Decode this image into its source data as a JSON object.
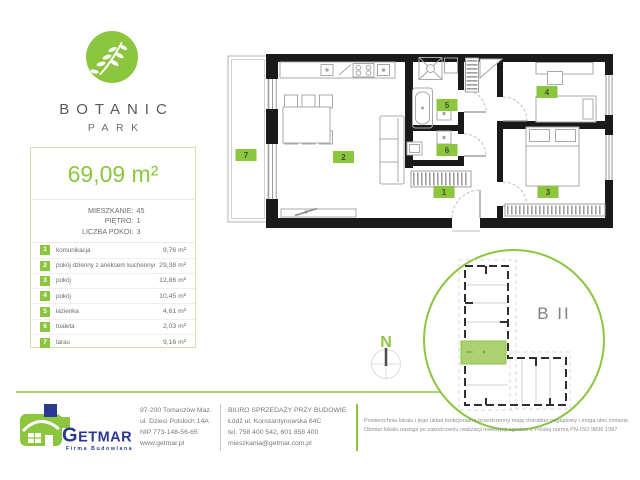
{
  "brand": {
    "line1": "BOTANIC",
    "line2": "PARK"
  },
  "unit": {
    "area": "69,09 m²",
    "details": [
      {
        "label": "MIESZKANIE:",
        "value": "45"
      },
      {
        "label": "PIĘTRO:",
        "value": "1"
      },
      {
        "label": "LICZBA POKOI:",
        "value": "3"
      }
    ]
  },
  "rooms": [
    {
      "no": "1",
      "name": "komunikacja",
      "area": "9,76 m²"
    },
    {
      "no": "2",
      "name": "pokój dzienny z aneksem kuchennym",
      "area": "29,38 m²"
    },
    {
      "no": "3",
      "name": "pokój",
      "area": "12,86 m²"
    },
    {
      "no": "4",
      "name": "pokój",
      "area": "10,45 m²"
    },
    {
      "no": "5",
      "name": "łazienka",
      "area": "4,61 m²"
    },
    {
      "no": "6",
      "name": "toaleta",
      "area": "2,03 m²"
    },
    {
      "no": "7",
      "name": "taras",
      "area": "9,16 m²"
    }
  ],
  "overview": {
    "building_label": "B II",
    "compass": "N"
  },
  "footer": {
    "logo": {
      "initial": "G",
      "rest": "ETMAR",
      "tagline": "Firma Budowlana"
    },
    "address_lines": [
      "97-200 Tomaszów Maz.",
      "ul. Dzieci Polskich 14A",
      "NIP 773-148-56-65",
      "www.getmar.pl"
    ],
    "office_lines": [
      "BIURO SPRZEDAŻY PRZY BUDOWIE",
      "Łódź ul. Konstantynowska 64C",
      "tel. 758 400 542, 601 858 400",
      "mieszkania@getmar.com.pl"
    ],
    "disclaimer_lines": [
      "Powierzchnia lokalu i jego układ funkcjonalno-przestrzenny mają charakter poglądowy i mogą ulec zmianie.",
      "Obmiar lokalu nastąpi po zakończeniu realizacji inwestycji zgodnie z Polską normą PN-ISO 9836:1997"
    ]
  },
  "colors": {
    "accent_green": "#8cc63e",
    "brand_navy": "#2b3990",
    "text_gray": "#58595b"
  }
}
